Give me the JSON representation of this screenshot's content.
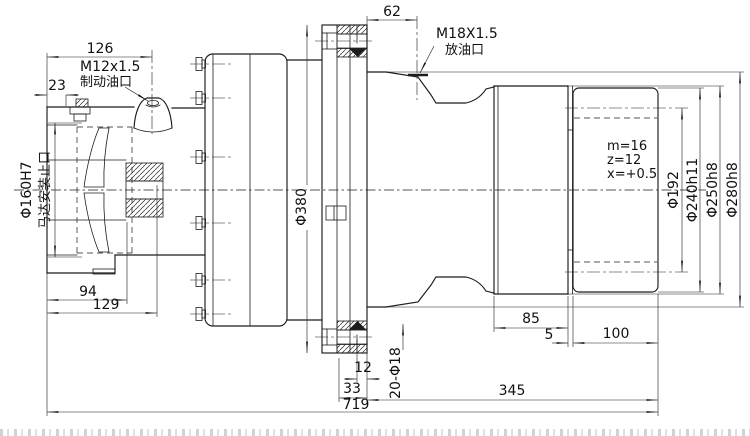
{
  "drawing": {
    "ports": {
      "brake_port_thread": "M12x1.5",
      "brake_port_name": "制动油口",
      "drain_port_thread": "M18X1.5",
      "drain_port_name": "放油口"
    },
    "motor_mount": {
      "spigot_dia": "Φ160H7",
      "spigot_label": "马达安装止口"
    },
    "flange": {
      "bolt_circle_dia": "Φ380",
      "holes": "20-Φ18"
    },
    "gear": {
      "module": "m=16",
      "teeth": "z=12",
      "profile_shift": "x=+0.5",
      "pitch_dia": "Φ192",
      "tip_dia": "Φ240h11",
      "seat_dia": "Φ250h8",
      "pilot_dia": "Φ280h8"
    },
    "dims": {
      "overall_length": "719",
      "flange_to_gear_end": "345",
      "gear_width": "100",
      "gear_gap": "5",
      "seat_width": "85",
      "flange_thickness": "33",
      "pilot_step": "12",
      "drain_offset": "62",
      "brake_port_offset": "126",
      "plug_offset": "23",
      "bore_depth_1": "94",
      "bore_depth_2": "129"
    }
  }
}
